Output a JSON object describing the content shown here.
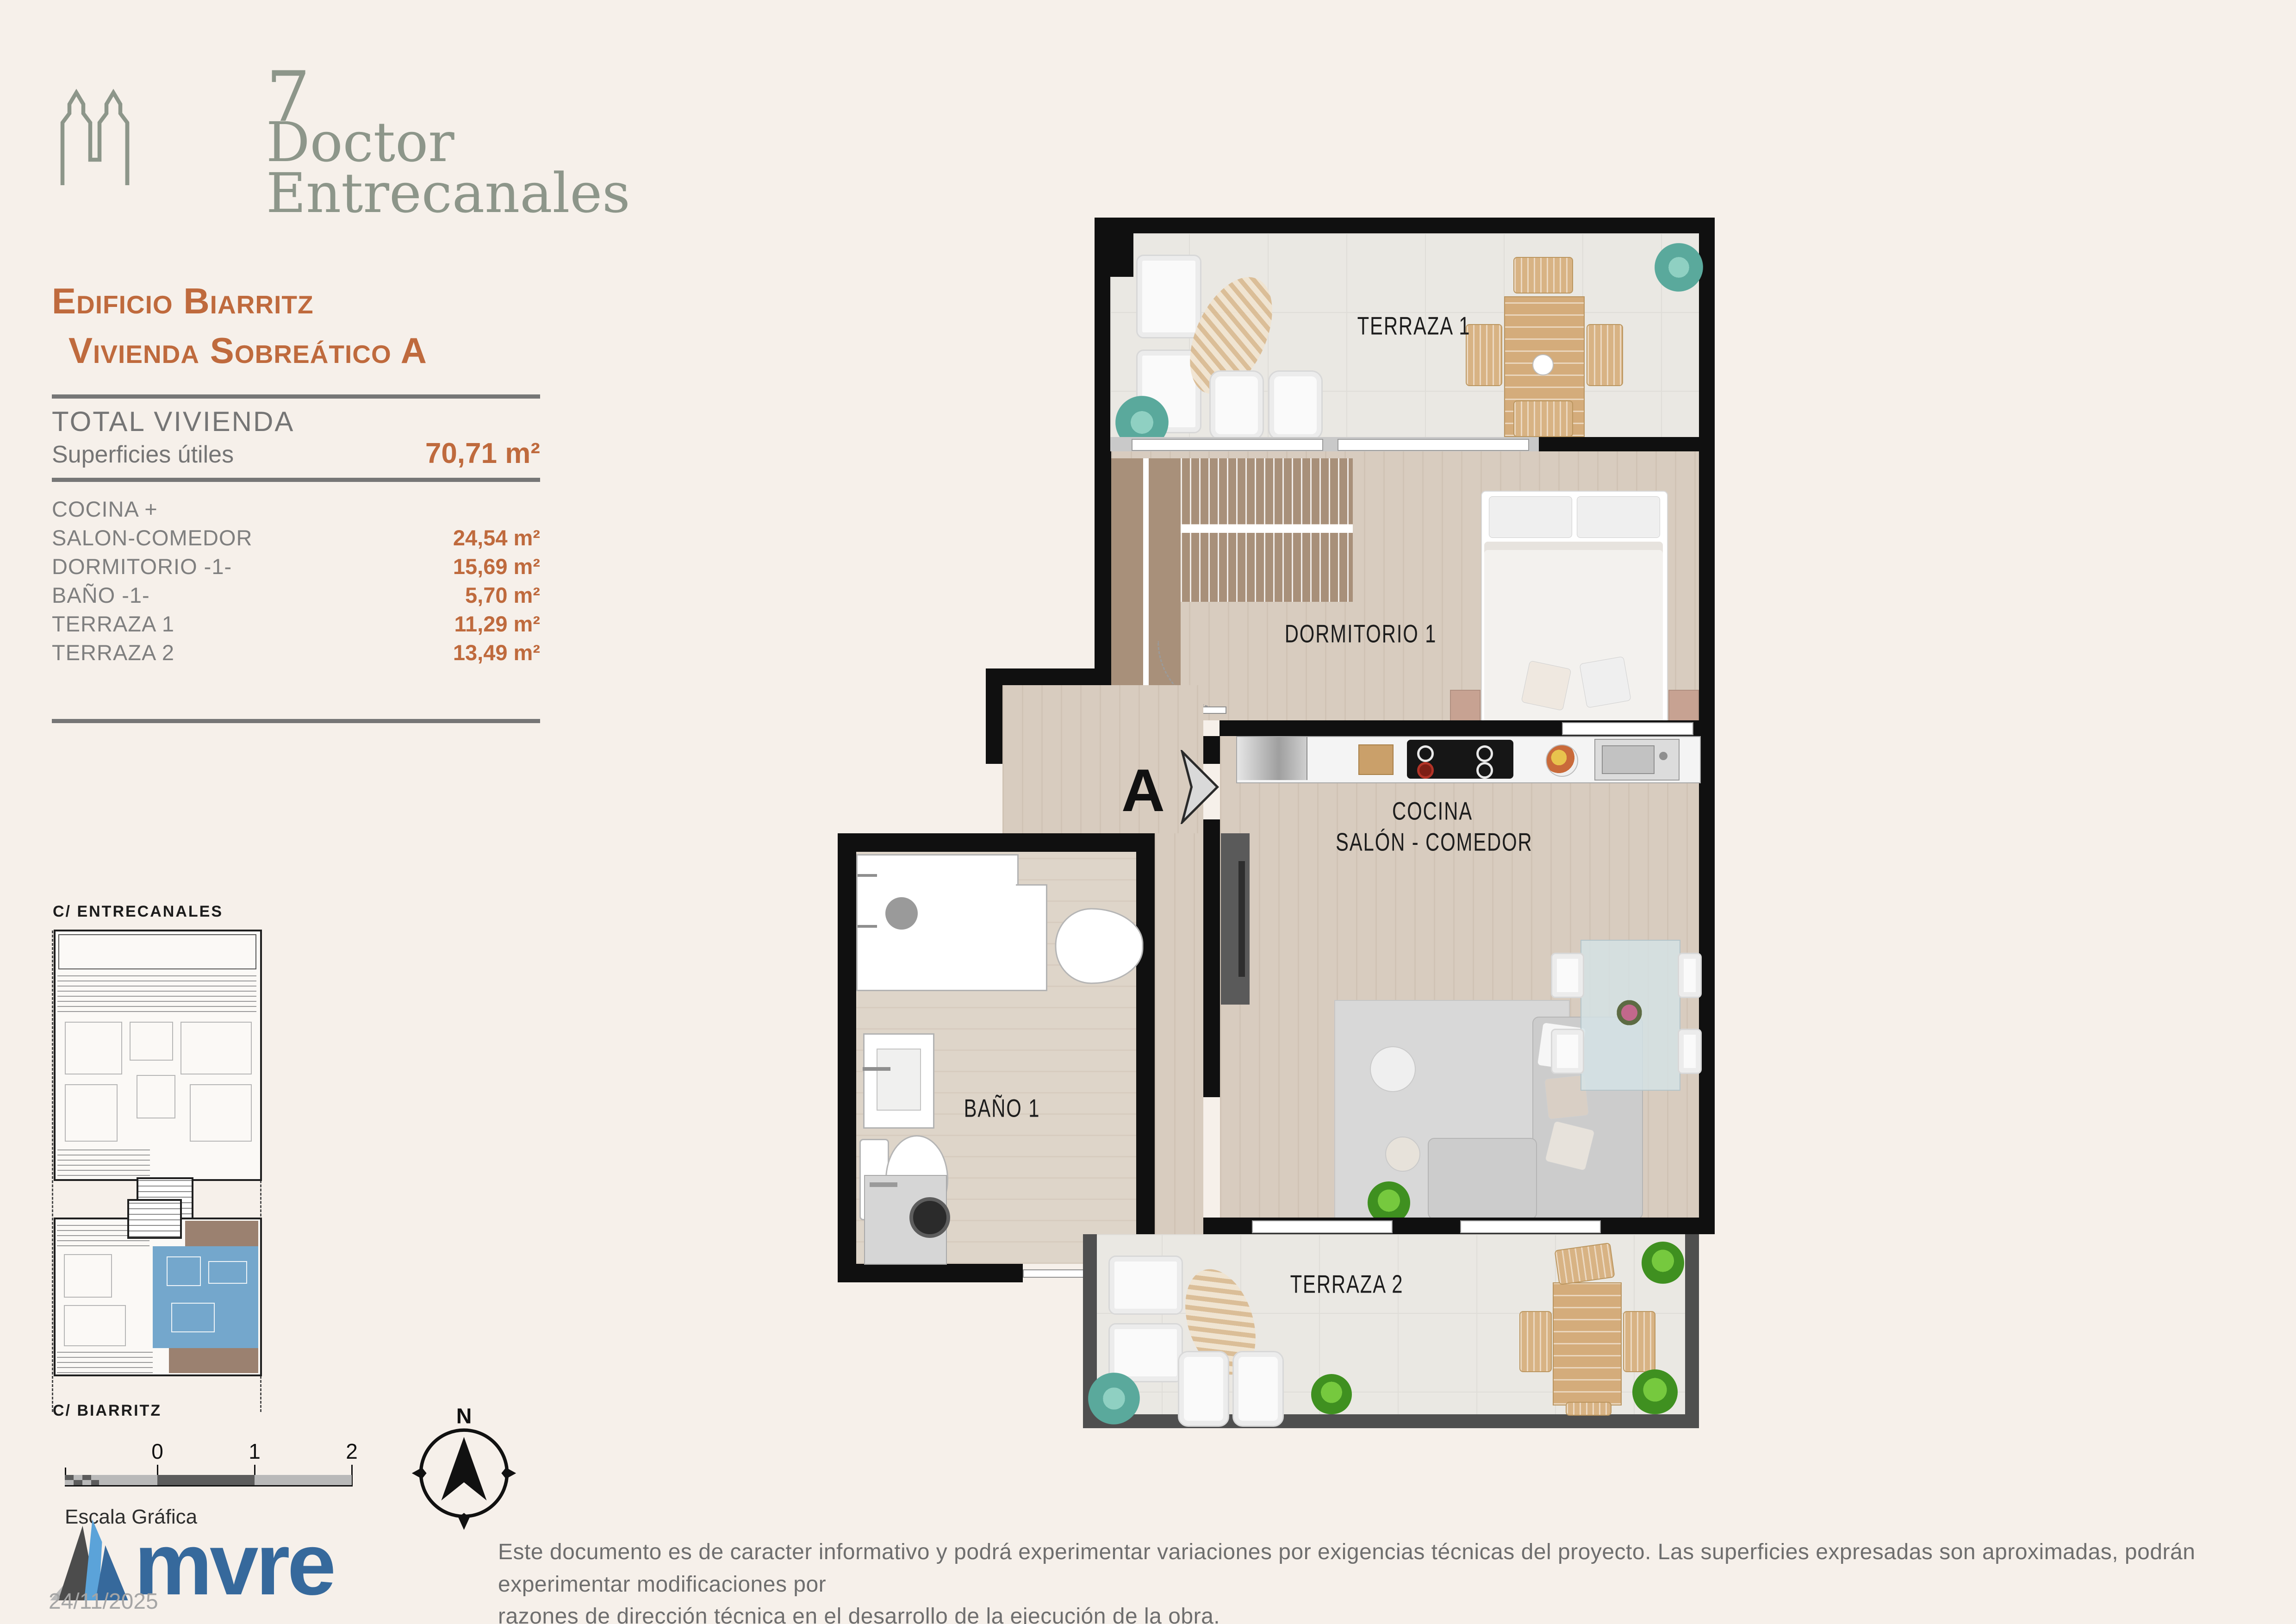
{
  "brand": {
    "number": "7",
    "name_line1": "Doctor",
    "name_line2": "Entrecanales"
  },
  "header": {
    "building": "Edificio Biarritz",
    "unit": "Vivienda Sobreático A"
  },
  "summary": {
    "total_label": "TOTAL VIVIENDA",
    "surfaces_label": "Superficies útiles",
    "total_value": "70,71 m²"
  },
  "rooms": {
    "rows": [
      {
        "label": "COCINA +",
        "value": ""
      },
      {
        "label": "SALON-COMEDOR",
        "value": "24,54 m²"
      },
      {
        "label": "DORMITORIO -1-",
        "value": "15,69 m²"
      },
      {
        "label": "BAÑO -1-",
        "value": "5,70 m²"
      },
      {
        "label": "TERRAZA 1",
        "value": "11,29 m²"
      },
      {
        "label": "TERRAZA 2",
        "value": "13,49 m²"
      }
    ]
  },
  "site": {
    "street_top": "C/ ENTRECANALES",
    "street_bottom": "C/ BIARRITZ"
  },
  "scale": {
    "label": "Escala Gráfica",
    "tick0": "0",
    "tick1": "1",
    "tick2": "2"
  },
  "compass": {
    "north_label": "N"
  },
  "plan": {
    "terraza1": "TERRAZA 1",
    "dormitorio": "DORMITORIO 1",
    "cocina_line1": "COCINA",
    "cocina_line2": "SALÓN - COMEDOR",
    "bano": "BAÑO 1",
    "terraza2": "TERRAZA 2",
    "section_marker": "A"
  },
  "footer": {
    "logo_text": "mvre",
    "date": "24/11/2025",
    "disclaimer_line1": "Este documento es de caracter informativo y podrá experimentar variaciones por exigencias técnicas del proyecto. Las superficies expresadas son aproximadas, podrán experimentar modificaciones por",
    "disclaimer_line2": "razones de dirección técnica en el desarrollo de la ejecución de la obra."
  },
  "colors": {
    "background": "#f6f0ea",
    "accent_orange": "#bf6a3d",
    "brand_sage": "#8d968a",
    "text_gray": "#7f7f7f",
    "mure_blue": "#36699c",
    "mure_lightblue": "#5ba3d9",
    "site_unit_blue": "#74a7cc",
    "site_terrace_brown": "#9b8170",
    "wall_black": "#101010"
  }
}
